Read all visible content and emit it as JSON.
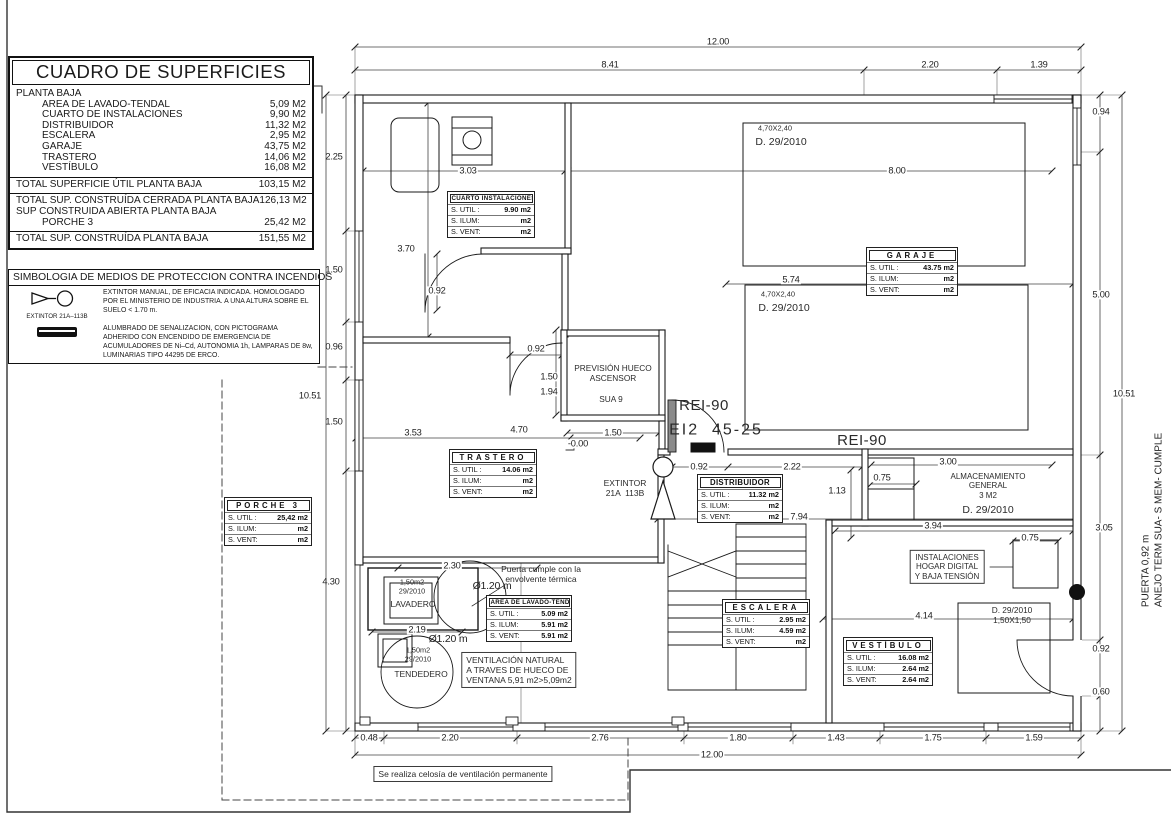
{
  "surfaces_table": {
    "title": "CUADRO DE SUPERFICIES",
    "section": "PLANTA BAJA",
    "items": [
      {
        "name": "AREA DE LAVADO-TENDAL",
        "value": "5,09 M2"
      },
      {
        "name": "CUARTO DE INSTALACIONES",
        "value": "9,90 M2"
      },
      {
        "name": "DISTRIBUIDOR",
        "value": "11,32 M2"
      },
      {
        "name": "ESCALERA",
        "value": "2,95 M2"
      },
      {
        "name": "GARAJE",
        "value": "43,75 M2"
      },
      {
        "name": "TRASTERO",
        "value": "14,06 M2"
      },
      {
        "name": "VESTÍBULO",
        "value": "16,08 M2"
      }
    ],
    "total_util": {
      "label": "TOTAL SUPERFICIE ÚTIL PLANTA BAJA",
      "value": "103,15 M2"
    },
    "constructed": [
      {
        "label": "TOTAL SUP. CONSTRUÍDA  CERRADA PLANTA BAJA",
        "value": "126,13 M2",
        "indent": false
      },
      {
        "label": "SUP CONSTRUIDA ABIERTA PLANTA BAJA",
        "value": "",
        "indent": false
      },
      {
        "label": "PORCHE 3",
        "value": "25,42 M2",
        "indent": true
      }
    ],
    "total_final": {
      "label": "TOTAL SUP. CONSTRUÍDA PLANTA BAJA",
      "value": "151,55 M2"
    }
  },
  "legend": {
    "title": "SIMBOLOGIA DE MEDIOS DE PROTECCION CONTRA INCENDIOS",
    "items": [
      {
        "symbol": "extintor-icon",
        "caption": "EXTINTOR 21A–113B",
        "text": "EXTINTOR MANUAL, DE EFICACIA INDICADA. HOMOLOGADO POR EL MINISTERIO DE INDUSTRIA. A UNA ALTURA SOBRE EL SUELO < 1.70 m."
      },
      {
        "symbol": "emergency-light-icon",
        "caption": "",
        "text": "ALUMBRADO DE SENALIZACION, CON PICTOGRAMA ADHERIDO CON ENCENDIDO DE EMERGENCIA DE ACUMULADORES DE Ni–Cd, AUTONOMIA 1h, LAMPARAS DE 8w, LUMINARIAS TIPO 44295 DE ERCO."
      }
    ]
  },
  "side_note": {
    "line1": "PUERTA 0,92 m",
    "line2": "ANEJO TERM SUA- S MEM- CUMPLE"
  },
  "plan": {
    "room_tables": [
      {
        "id": "cuarto-instalaciones",
        "x": 447,
        "y": 191,
        "w": 86,
        "title": "CUARTO  INSTALACIONES",
        "small": true,
        "spaced": false,
        "rows": [
          [
            "S. UTIL :",
            "9.90 m2"
          ],
          [
            "S. ILUM:",
            "m2"
          ],
          [
            "S. VENT:",
            "m2"
          ]
        ]
      },
      {
        "id": "garaje",
        "x": 866,
        "y": 247,
        "w": 90,
        "title": "GARAJE",
        "spaced": true,
        "rows": [
          [
            "S. UTIL :",
            "43.75 m2"
          ],
          [
            "S. ILUM:",
            "m2"
          ],
          [
            "S. VENT:",
            "m2"
          ]
        ]
      },
      {
        "id": "trastero",
        "x": 449,
        "y": 449,
        "w": 86,
        "title": "TRASTERO",
        "spaced": true,
        "rows": [
          [
            "S. UTIL :",
            "14.06 m2"
          ],
          [
            "S. ILUM:",
            "m2"
          ],
          [
            "S. VENT:",
            "m2"
          ]
        ]
      },
      {
        "id": "distribuidor",
        "x": 697,
        "y": 474,
        "w": 84,
        "title": "DISTRIBUIDOR",
        "spaced": false,
        "rows": [
          [
            "S. UTIL :",
            "11.32 m2"
          ],
          [
            "S. ILUM:",
            "m2"
          ],
          [
            "S. VENT:",
            "m2"
          ]
        ]
      },
      {
        "id": "escalera",
        "x": 722,
        "y": 599,
        "w": 86,
        "title": "ESCALERA",
        "spaced": true,
        "rows": [
          [
            "S. UTIL :",
            "2.95 m2"
          ],
          [
            "S. ILUM:",
            "4.59 m2"
          ],
          [
            "S. VENT:",
            "m2"
          ]
        ]
      },
      {
        "id": "vestibulo",
        "x": 843,
        "y": 637,
        "w": 88,
        "title": "VESTÍBULO",
        "spaced": true,
        "rows": [
          [
            "S. UTIL :",
            "16.08 m2"
          ],
          [
            "S. ILUM:",
            "2.64 m2"
          ],
          [
            "S. VENT:",
            "2.64 m2"
          ]
        ]
      },
      {
        "id": "porche-3",
        "x": 224,
        "y": 497,
        "w": 86,
        "title": "PORCHE  3",
        "spaced": true,
        "rows": [
          [
            "S. UTIL :",
            "25,42 m2"
          ],
          [
            "S. ILUM:",
            "m2"
          ],
          [
            "S. VENT:",
            "m2"
          ]
        ]
      },
      {
        "id": "area-lavado-tendal",
        "x": 486,
        "y": 595,
        "w": 84,
        "title": "AREA DE LAVADO-TENDAL",
        "small": true,
        "spaced": false,
        "rows": [
          [
            "S. UTIL :",
            "5.09 m2"
          ],
          [
            "S. ILUM:",
            "5.91 m2"
          ],
          [
            "S. VENT:",
            "5.91 m2"
          ]
        ]
      }
    ],
    "dimensions": [
      {
        "t": "12.00",
        "x": 718,
        "y": 42,
        "bg": 1
      },
      {
        "t": "8.41",
        "x": 610,
        "y": 65,
        "bg": 1
      },
      {
        "t": "2.20",
        "x": 930,
        "y": 65,
        "bg": 1
      },
      {
        "t": "1.39",
        "x": 1039,
        "y": 65,
        "bg": 1
      },
      {
        "t": "2.25",
        "x": 334,
        "y": 157
      },
      {
        "t": "1.50",
        "x": 334,
        "y": 270
      },
      {
        "t": "0.96",
        "x": 334,
        "y": 347
      },
      {
        "t": "1.50",
        "x": 334,
        "y": 422
      },
      {
        "t": "4.30",
        "x": 331,
        "y": 582
      },
      {
        "t": "10.51",
        "x": 310,
        "y": 396
      },
      {
        "t": "0.94",
        "x": 1101,
        "y": 112,
        "bg": 1
      },
      {
        "t": "5.00",
        "x": 1101,
        "y": 295,
        "bg": 1
      },
      {
        "t": "10.51",
        "x": 1124,
        "y": 394,
        "bg": 1
      },
      {
        "t": "3.05",
        "x": 1104,
        "y": 528,
        "bg": 1
      },
      {
        "t": "0.92",
        "x": 1101,
        "y": 649,
        "bg": 1
      },
      {
        "t": "0.60",
        "x": 1101,
        "y": 692,
        "bg": 1
      },
      {
        "t": "0.48",
        "x": 369,
        "y": 738,
        "bg": 1
      },
      {
        "t": "2.20",
        "x": 450,
        "y": 738,
        "bg": 1
      },
      {
        "t": "2.76",
        "x": 600,
        "y": 738,
        "bg": 1
      },
      {
        "t": "1.80",
        "x": 738,
        "y": 738,
        "bg": 1
      },
      {
        "t": "1.43",
        "x": 836,
        "y": 738,
        "bg": 1
      },
      {
        "t": "1.75",
        "x": 933,
        "y": 738,
        "bg": 1
      },
      {
        "t": "1.59",
        "x": 1034,
        "y": 738,
        "bg": 1
      },
      {
        "t": "12.00",
        "x": 712,
        "y": 755,
        "bg": 1
      },
      {
        "t": "3.03",
        "x": 468,
        "y": 171,
        "bg": 1
      },
      {
        "t": "8.00",
        "x": 897,
        "y": 171,
        "bg": 1
      },
      {
        "t": "3.70",
        "x": 406,
        "y": 249,
        "bg": 1
      },
      {
        "t": "0.92",
        "x": 437,
        "y": 291,
        "bg": 1
      },
      {
        "t": "5.74",
        "x": 791,
        "y": 280,
        "bg": 1
      },
      {
        "t": "0.92",
        "x": 536,
        "y": 349,
        "bg": 1
      },
      {
        "t": "1.50",
        "x": 549,
        "y": 377,
        "bg": 1
      },
      {
        "t": "1.94",
        "x": 549,
        "y": 392,
        "bg": 1
      },
      {
        "t": "1.50",
        "x": 613,
        "y": 433,
        "bg": 1
      },
      {
        "t": "-0.00",
        "x": 578,
        "y": 444,
        "bg": 1
      },
      {
        "t": "3.53",
        "x": 413,
        "y": 433,
        "bg": 1
      },
      {
        "t": "4.70",
        "x": 519,
        "y": 430,
        "bg": 1
      },
      {
        "t": "0.92",
        "x": 699,
        "y": 467,
        "bg": 1
      },
      {
        "t": "2.22",
        "x": 792,
        "y": 467,
        "bg": 1
      },
      {
        "t": "1.13",
        "x": 837,
        "y": 491,
        "bg": 1
      },
      {
        "t": "0.75",
        "x": 882,
        "y": 478,
        "bg": 1
      },
      {
        "t": "3.00",
        "x": 948,
        "y": 462,
        "bg": 1
      },
      {
        "t": "7.94",
        "x": 799,
        "y": 517,
        "bg": 1
      },
      {
        "t": "3.94",
        "x": 933,
        "y": 526,
        "bg": 1
      },
      {
        "t": "0.75",
        "x": 1030,
        "y": 538,
        "bg": 1
      },
      {
        "t": "4.14",
        "x": 924,
        "y": 616,
        "bg": 1
      },
      {
        "t": "2.30",
        "x": 452,
        "y": 566,
        "bg": 1
      },
      {
        "t": "2.19",
        "x": 417,
        "y": 630,
        "bg": 1
      },
      {
        "t": "Ø1.20 m",
        "x": 492,
        "y": 586,
        "s": 10.5
      },
      {
        "t": "Ø1.20 m",
        "x": 448,
        "y": 639,
        "s": 10.5
      }
    ],
    "annotations": [
      {
        "id": "prevision-hueco",
        "t": "PREVISIÓN HUECO\nASCENSOR",
        "x": 613,
        "y": 374,
        "s": 8.3
      },
      {
        "id": "sua9",
        "t": "SUA 9",
        "x": 611,
        "y": 400,
        "s": 8.3
      },
      {
        "id": "rei90-a",
        "t": "REI-90",
        "x": 704,
        "y": 406,
        "s": 15,
        "ls": 0.5
      },
      {
        "id": "rei90-b",
        "t": "REI-90",
        "x": 862,
        "y": 441,
        "s": 15,
        "ls": 0.5
      },
      {
        "id": "ei2-45",
        "t": "EI2  45-25",
        "x": 716,
        "y": 431,
        "s": 16,
        "ls": 2
      },
      {
        "id": "extintor-plan-label",
        "t": "EXTINTOR\n21A  113B",
        "x": 625,
        "y": 488,
        "s": 8.5
      },
      {
        "id": "parking1-size",
        "t": "4,70X2,40",
        "x": 775,
        "y": 129,
        "s": 7.5
      },
      {
        "id": "parking1-d",
        "t": "D. 29/2010",
        "x": 781,
        "y": 142,
        "s": 10.5
      },
      {
        "id": "parking2-size",
        "t": "4,70X2,40",
        "x": 778,
        "y": 295,
        "s": 7.5
      },
      {
        "id": "parking2-d",
        "t": "D. 29/2010",
        "x": 784,
        "y": 308,
        "s": 10.5
      },
      {
        "id": "almacenamiento",
        "t": "ALMACENAMIENTO\nGENERAL\n3 M2",
        "x": 988,
        "y": 486,
        "s": 8
      },
      {
        "id": "almacenamiento-d",
        "t": "D. 29/2010",
        "x": 988,
        "y": 510,
        "s": 10.5
      },
      {
        "id": "instalaciones-hogar",
        "t": "INSTALACIONES\nHOGAR DIGITAL\nY BAJA TENSIÓN",
        "x": 947,
        "y": 567,
        "s": 8,
        "box": 1
      },
      {
        "id": "vestibulo-window",
        "t": "D. 29/2010\n1,50X1,50",
        "x": 1012,
        "y": 616,
        "s": 8.3
      },
      {
        "id": "lavadero-meta",
        "t": "1,50m2\n29/2010",
        "x": 412,
        "y": 587,
        "s": 7.3
      },
      {
        "id": "lavadero-name",
        "t": "LAVADERO",
        "x": 413,
        "y": 604,
        "s": 8.5
      },
      {
        "id": "tendedero-meta",
        "t": "1,50m2\n29/2010",
        "x": 418,
        "y": 655,
        "s": 7.3
      },
      {
        "id": "tendedero-name",
        "t": "TENDEDERO",
        "x": 421,
        "y": 674,
        "s": 8.5
      },
      {
        "id": "puerta-envolvente",
        "t": "Puerta cumple con la\nenvolvente térmica",
        "x": 541,
        "y": 574,
        "s": 8.5
      },
      {
        "id": "ventilacion-natural",
        "t": "VENTILACIÓN NATURAL\nA TRAVES DE HUECO DE\nVENTANA 5,91 m2>5,09m2",
        "x": 519,
        "y": 670,
        "s": 8.5,
        "box": 1,
        "left": 1
      },
      {
        "id": "celosia",
        "t": "Se realiza celosía de ventilación permanente",
        "x": 463,
        "y": 774,
        "s": 8.5,
        "box": 1
      }
    ]
  }
}
